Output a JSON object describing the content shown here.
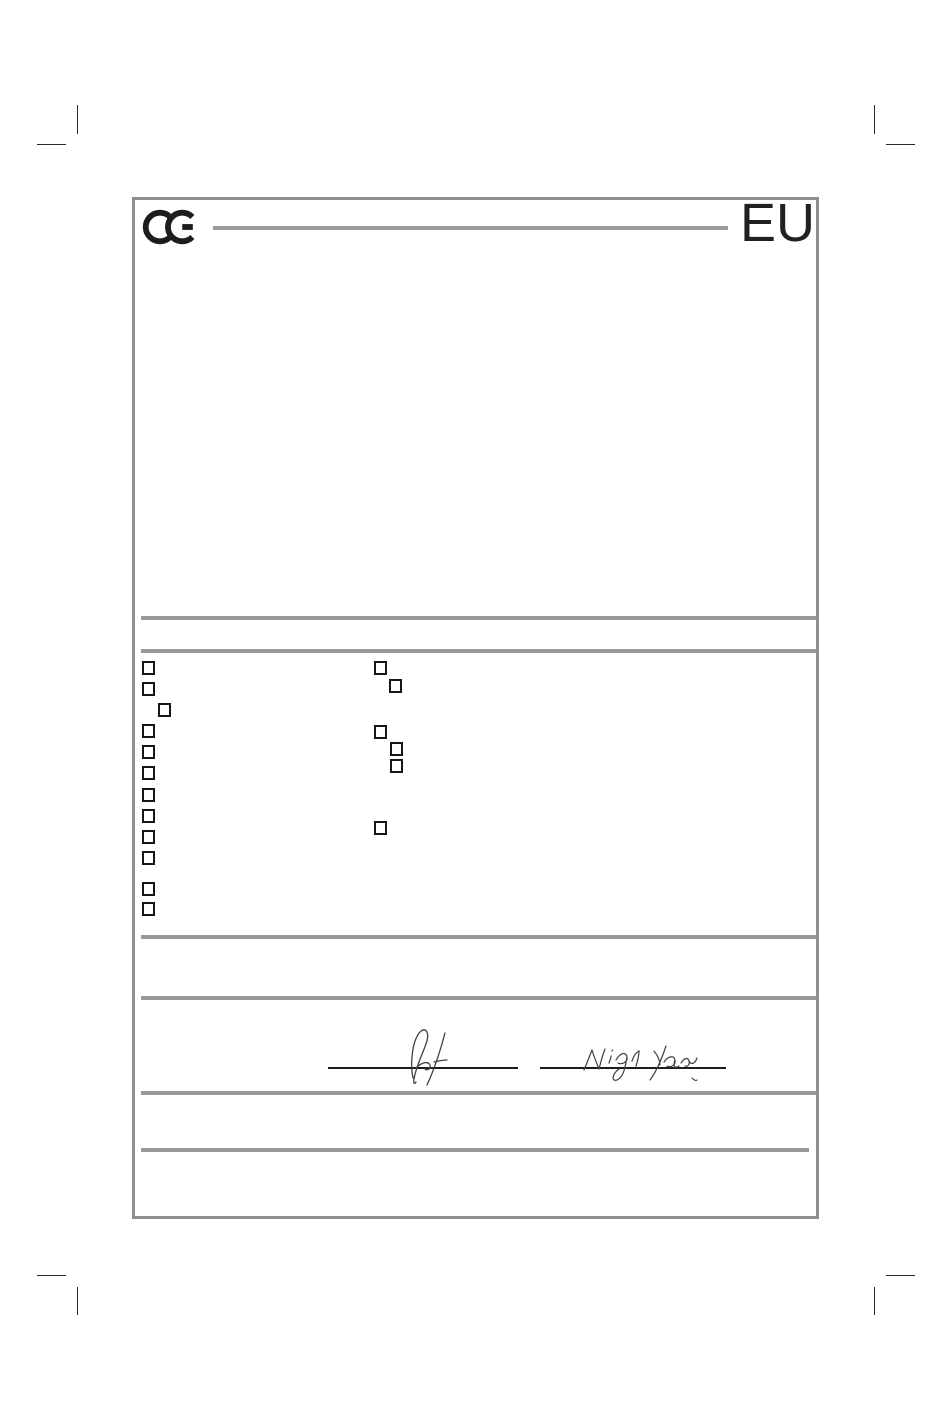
{
  "header": {
    "eu_label": "EU",
    "ce_icon": "ce-marking-logo"
  },
  "colors": {
    "rule_gray": "#989898",
    "frame_gray": "#8e8e8e",
    "ink_black": "#231f20",
    "signature_ink": "#3f3f3f"
  },
  "form": {
    "checkboxes": {
      "left_column_count": 12,
      "right_column_count": 6,
      "checked_count": 0,
      "state": "all unchecked"
    },
    "signatures": {
      "signature_1": "handwritten initials (illegible scribble)",
      "signature_2": "handwritten name resembling Nigel Yang"
    },
    "dividers": 6
  }
}
